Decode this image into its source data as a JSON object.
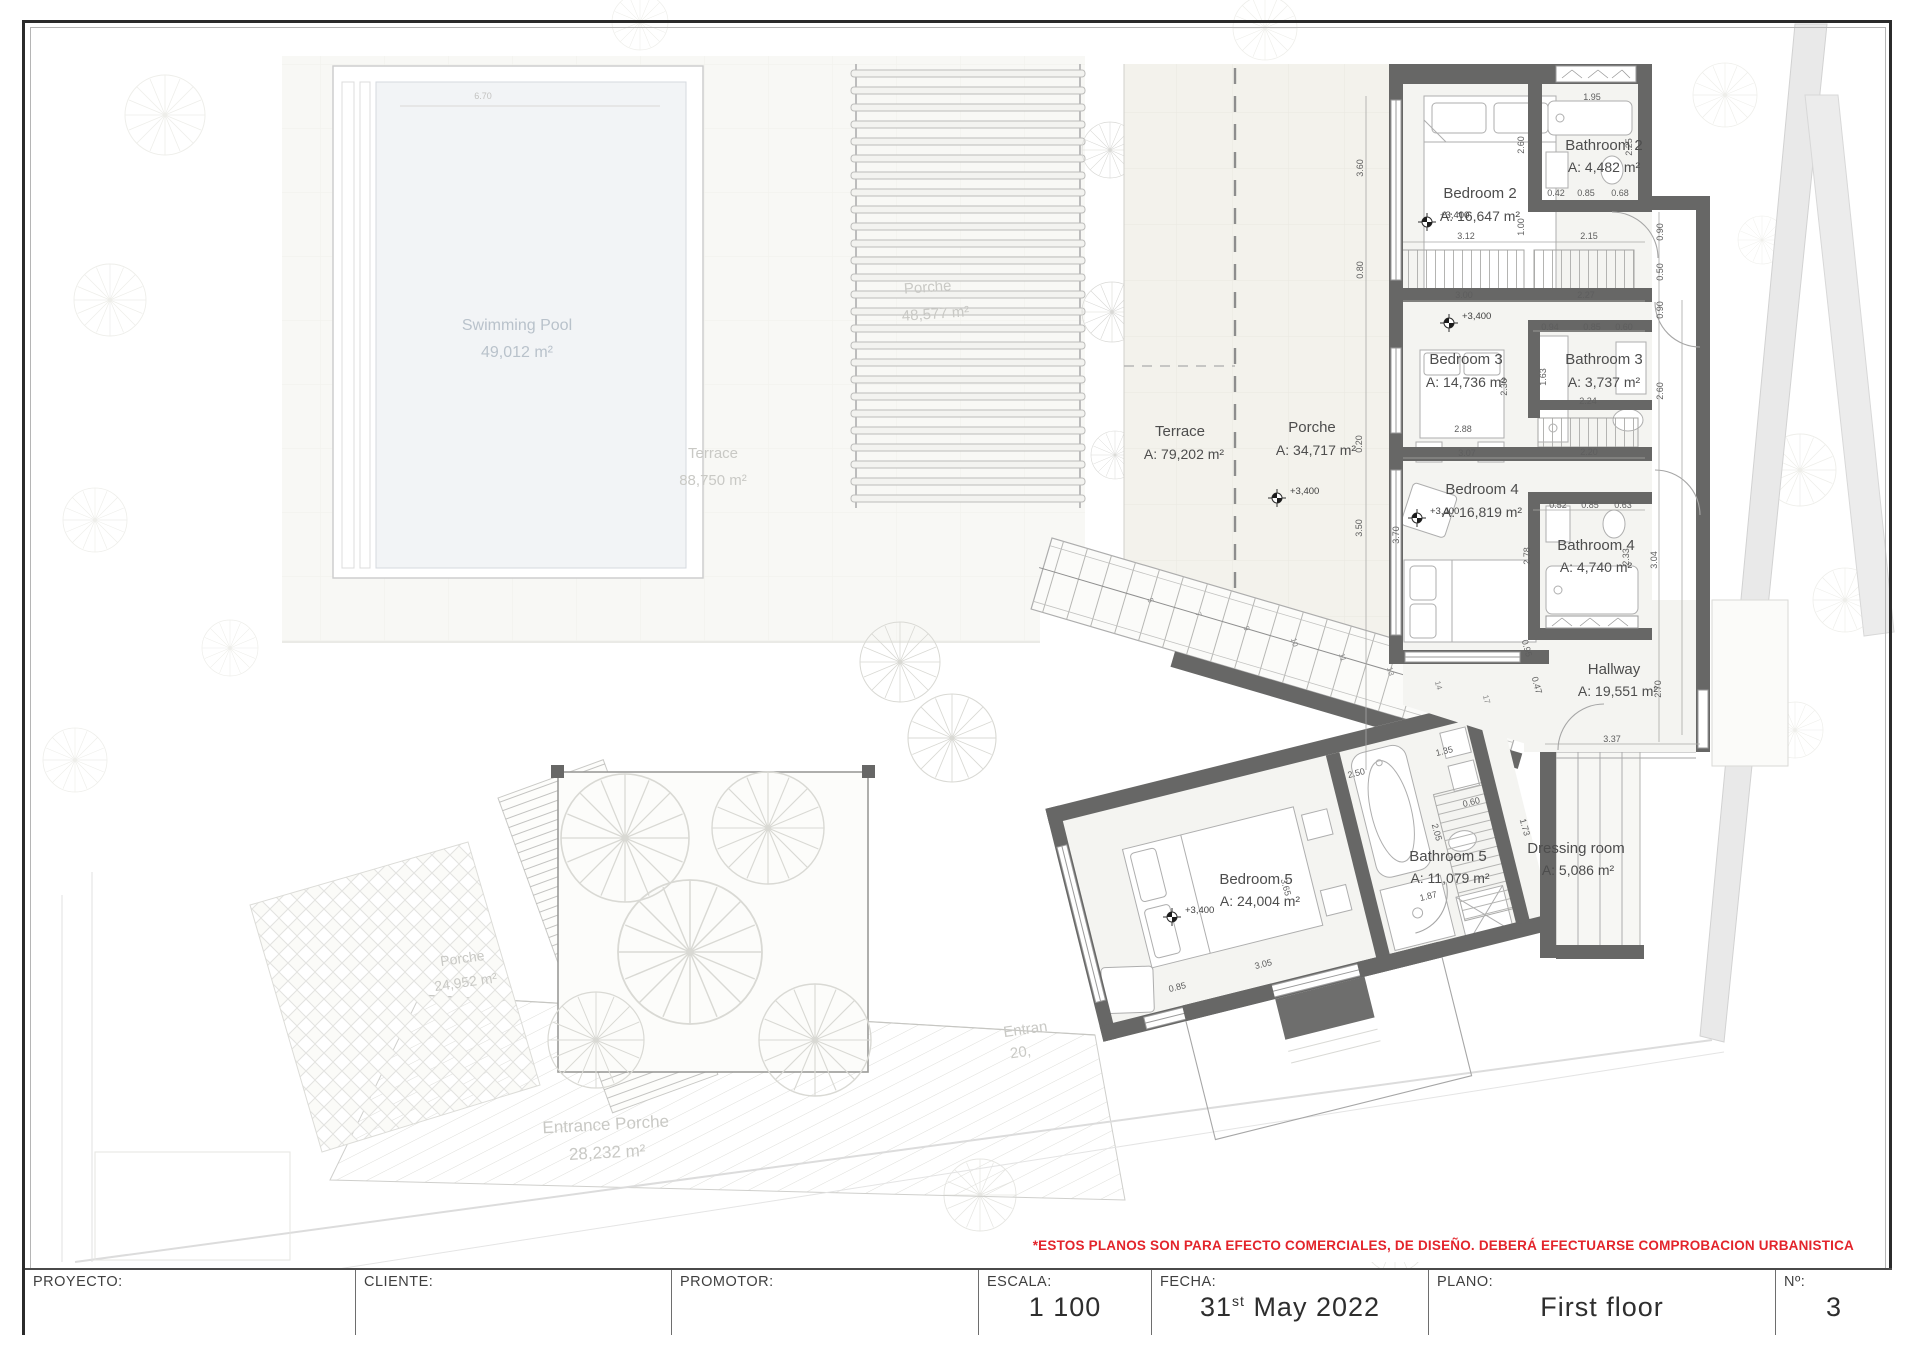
{
  "site_labels": {
    "pool": {
      "name": "Swimming Pool",
      "area": "49,012 m²"
    },
    "terrace_garden": {
      "name": "Terrace",
      "area": "88,750 m²"
    },
    "porche_pergola": {
      "name": "Porche",
      "area": "48,577 m²"
    },
    "porche_tiled": {
      "name": "Porche",
      "area": "24,952 m²"
    },
    "entrance_porche": {
      "name": "Entrance Porche",
      "area": "28,232 m²"
    },
    "entrance_partial": {
      "line1": "Entran",
      "line2": "20,"
    }
  },
  "rooms": {
    "terrace": {
      "name": "Terrace",
      "area": "A: 79,202 m²"
    },
    "porche": {
      "name": "Porche",
      "area": "A: 34,717 m²"
    },
    "bedroom2": {
      "name": "Bedroom 2",
      "area": "A: 16,647 m²"
    },
    "bathroom2": {
      "name": "Bathroom 2",
      "area": "A: 4,482 m²"
    },
    "bedroom3": {
      "name": "Bedroom 3",
      "area": "A: 14,736 m²"
    },
    "bathroom3": {
      "name": "Bathroom 3",
      "area": "A: 3,737 m²"
    },
    "bedroom4": {
      "name": "Bedroom 4",
      "area": "A: 16,819 m²"
    },
    "bathroom4": {
      "name": "Bathroom 4",
      "area": "A: 4,740 m²"
    },
    "hallway": {
      "name": "Hallway",
      "area": "A: 19,551 m²"
    },
    "bedroom5": {
      "name": "Bedroom 5",
      "area": "A: 24,004 m²"
    },
    "bathroom5": {
      "name": "Bathroom 5",
      "area": "A: 11,079 m²"
    },
    "dressing": {
      "name": "Dressing room",
      "area": "A: 5,086 m²"
    }
  },
  "level_marker": "+3,400",
  "pool_dim": "6.70",
  "dims": [
    "3.12",
    "2.15",
    "1.00",
    "2.60",
    "1.95",
    "2.25",
    "0.42",
    "0.85",
    "0.68",
    "0.90",
    "0.50",
    "3.60",
    "0.80",
    "3.00",
    "2.27",
    "0.94",
    "0.85",
    "0.60",
    "1.63",
    "2.30",
    "2.24",
    "2.88",
    "3.07",
    "2.20",
    "0.90",
    "2.60",
    "0.52",
    "0.85",
    "0.63",
    "2.78",
    "2.33",
    "3.04",
    "2.70",
    "3.37",
    "0.95",
    "0.47",
    "0.20",
    "3.50",
    "3.70",
    "2.50",
    "1.35",
    "0.60",
    "1.73",
    "1.87",
    "3.65",
    "3.05",
    "0.85",
    "2.05"
  ],
  "stair_numbers": [
    "5",
    "7",
    "9",
    "10",
    "11",
    "13",
    "14",
    "17"
  ],
  "disclaimer": "*ESTOS PLANOS SON PARA EFECTO COMERCIALES, DE DISEÑO. DEBERÁ EFECTUARSE COMPROBACION URBANISTICA",
  "title_block": {
    "proyecto_label": "PROYECTO:",
    "cliente_label": "CLIENTE:",
    "promotor_label": "PROMOTOR:",
    "escala_label": "ESCALA:",
    "escala_value": "1 100",
    "fecha_label": "FECHA:",
    "fecha_day": "31",
    "fecha_ord": "st",
    "fecha_rest": "May  2022",
    "plano_label": "PLANO:",
    "plano_value": "First floor",
    "numero_label": "Nº:",
    "numero_value": "3"
  },
  "colors": {
    "wall": "#676766",
    "accent_red": "#e3242b"
  }
}
